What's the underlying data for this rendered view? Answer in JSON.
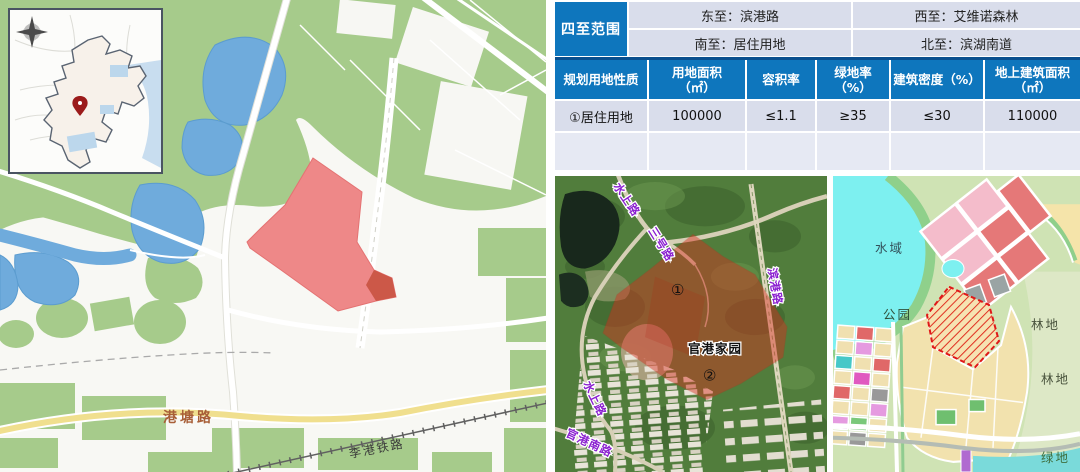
{
  "colors": {
    "header_blue": "#0e76bd",
    "header_border_blue": "#0a4f8e",
    "cell_light": "#d9ddeb",
    "cell_lighter": "#e6e9f3",
    "parcel_red": "#ee8888",
    "satellite_overlay_red": "#d92f1f",
    "road_label_brown": "#a85f38",
    "satellite_label_purple": "#8a1fd0",
    "plan_water_cyan": "#7df0f0"
  },
  "left_map": {
    "road_label": "港塘路",
    "railway_label": "李港铁路"
  },
  "boundary_table": {
    "title": "四至范围",
    "east": "东至：滨港路",
    "west": "西至：艾维诺森林",
    "south": "南至：居住用地",
    "north": "北至：滨湖南道"
  },
  "planning_table": {
    "headers": [
      "规划用地性质",
      "用地面积\n（㎡）",
      "容积率",
      "绿地率\n（%）",
      "建筑密度（%）",
      "地上建筑面积\n（㎡）"
    ],
    "row": [
      "①居住用地",
      "100000",
      "≤1.1",
      "≥35",
      "≤30",
      "110000"
    ]
  },
  "satellite_map": {
    "labels": {
      "shuishang_top": "水上路",
      "sanhao_road": "三号路",
      "bingang_road": "滨港路",
      "shuishang_left": "水上路",
      "guangang_south_road": "官港南路",
      "guangang_estate": "官港家园"
    },
    "markers": {
      "m1": "①",
      "m2": "②"
    }
  },
  "plan_map": {
    "labels": {
      "water": "水域",
      "park": "公园",
      "forest_top": "林地",
      "forest_mid": "林地",
      "green": "绿地"
    }
  }
}
